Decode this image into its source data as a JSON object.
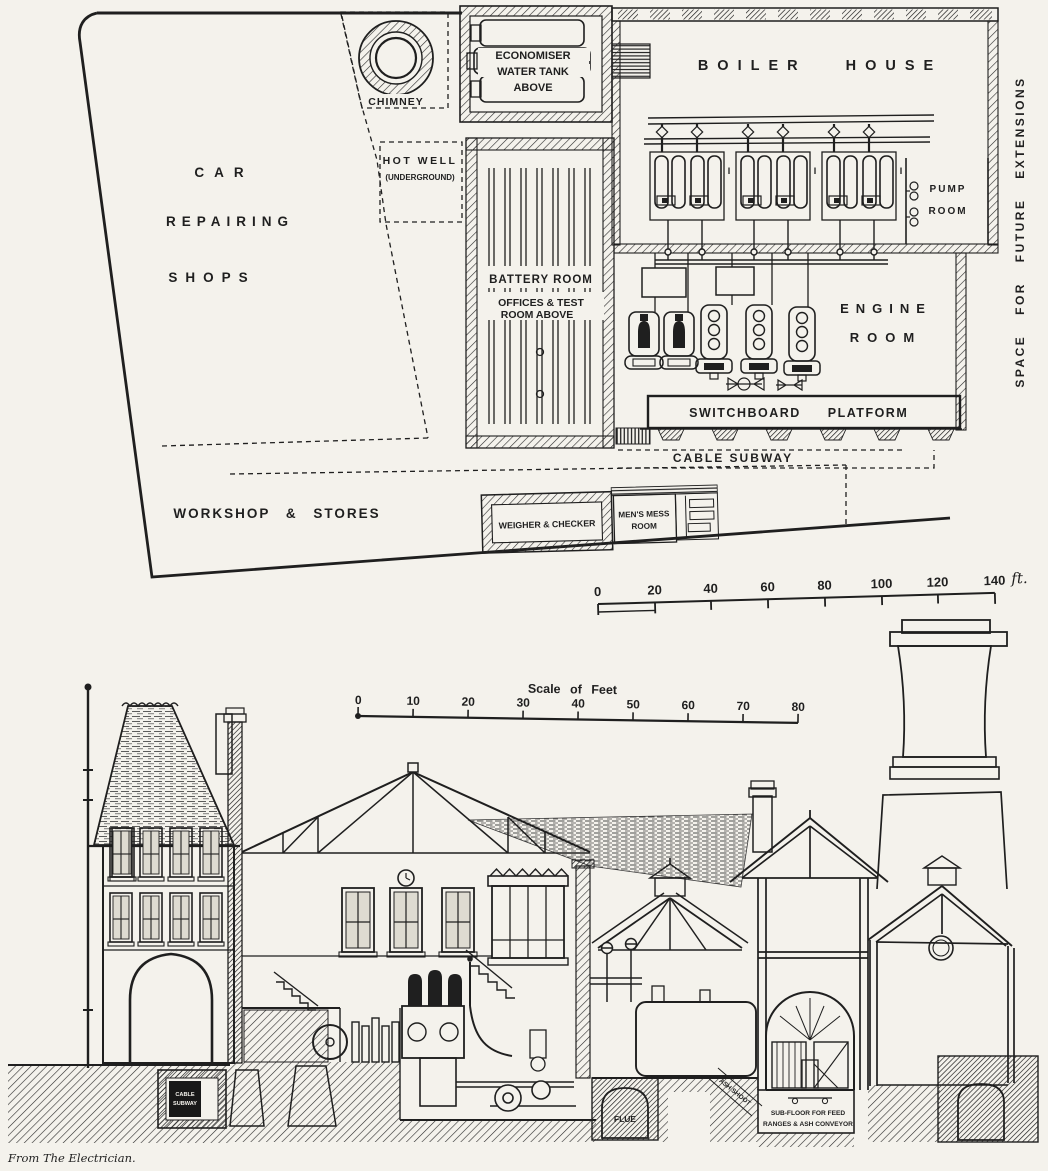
{
  "page": {
    "paper_color": "#f4f2ec",
    "ink_color": "#1f1f1f"
  },
  "plan": {
    "labels": {
      "car1": "CAR",
      "car2": "REPAIRING",
      "car3": "SHOPS",
      "chimney": "CHIMNEY",
      "hot_well1": "HOT WELL",
      "hot_well2": "(UNDERGROUND)",
      "econ1": "ECONOMISER",
      "econ2": "WATER TANK",
      "econ3": "ABOVE",
      "boiler_house": "BOILER HOUSE",
      "boiler_mark": "I",
      "pump1": "PUMP",
      "pump2": "ROOM",
      "space_future": "SPACE FOR FUTURE EXTENSIONS",
      "battery1": "BATTERY ROOM",
      "battery2": "OFFICES & TEST",
      "battery3": "ROOM ABOVE",
      "engine1": "ENGINE",
      "engine2": "ROOM",
      "switchboard": "SWITCHBOARD",
      "platform": "PLATFORM",
      "cable_subway": "CABLE   SUBWAY",
      "workshop": "WORKSHOP  &  STORES",
      "weigher": "WEIGHER & CHECKER",
      "mess1": "MEN'S MESS",
      "mess2": "ROOM"
    },
    "scale": {
      "ticks": [
        "0",
        "20",
        "40",
        "60",
        "80",
        "100",
        "120",
        "140"
      ],
      "unit": "ft."
    }
  },
  "section": {
    "scale": {
      "title": "Scale of Feet",
      "ticks": [
        "0",
        "10",
        "20",
        "30",
        "40",
        "50",
        "60",
        "70",
        "80"
      ]
    },
    "labels": {
      "cable1": "CABLE",
      "cable2": "SUBWAY",
      "flue": "FLUE",
      "ash_shoot": "ASH SHOOT",
      "subfloor1": "SUB-FLOOR FOR FEED",
      "subfloor2": "RANGES & ASH CONVEYOR"
    }
  },
  "caption": "From The Electrician."
}
